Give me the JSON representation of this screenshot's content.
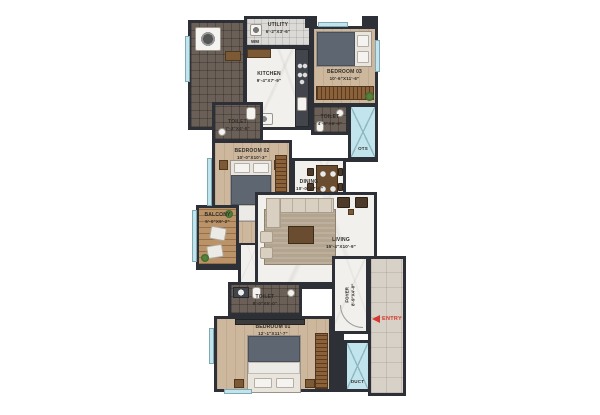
{
  "plan": {
    "rooms": {
      "utility": {
        "name": "UTILITY",
        "dims": "6'-2\"X3'-6\""
      },
      "wm": {
        "label": "WM"
      },
      "kitchen": {
        "name": "KITCHEN",
        "dims": "9'-4\"X7'-9\""
      },
      "bedroom3": {
        "name": "BEDROOM 03",
        "dims": "10'-6\"X11'-6\""
      },
      "toilet3": {
        "name": "TOILET",
        "dims": "4'-6\"X6'-0\""
      },
      "ots": {
        "name": "OTS"
      },
      "toilet2": {
        "name": "TOILET",
        "dims": "7'-3\"X4'-0\""
      },
      "bedroom2": {
        "name": "BEDROOM 02",
        "dims": "10'-0\"X10'-3\""
      },
      "dining": {
        "name": "DINING",
        "dims": "10'-0\"X7'-0\""
      },
      "balcony": {
        "name": "BALCONY",
        "dims": "5'-0\"X9'-2\""
      },
      "living": {
        "name": "LIVING",
        "dims": "15'-4\"X10'-9\""
      },
      "toilet1": {
        "name": "TOILET",
        "dims": "8'-0\"X5'-0\""
      },
      "bedroom1": {
        "name": "BEDROOM 01",
        "dims": "12'-1\"X11'-7\""
      },
      "foyer": {
        "name": "FOYER",
        "dims": "8'-9\"X4'-0\""
      },
      "duct": {
        "name": "DUCT"
      },
      "entry": {
        "label": "ENTRY"
      }
    },
    "colors": {
      "wall": "#2d3036",
      "wood_floor": "#cdb89e",
      "marble_floor": "#f2f0ec",
      "dark_tile": "#6b6058",
      "balcony_wood": "#bb9368",
      "shaft_fill": "#c2e4ec",
      "entry_red": "#d93a30",
      "label_text": "#2f2c28"
    }
  }
}
